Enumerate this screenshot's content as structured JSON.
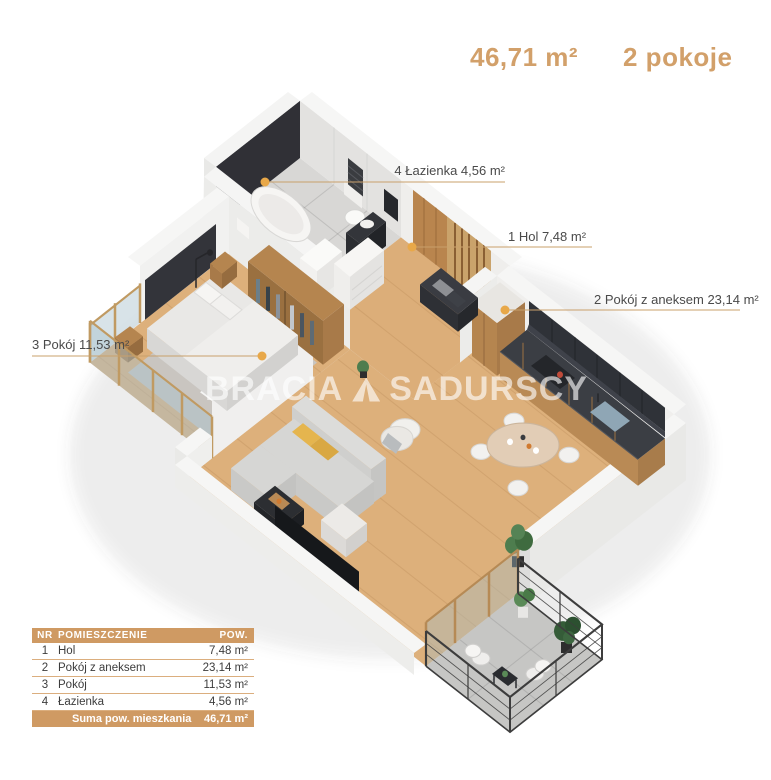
{
  "header": {
    "area": "46,71 m²",
    "rooms": "2 pokoje"
  },
  "labels": {
    "bathroom": "4 Łazienka 4,56 m²",
    "hall": "1 Hol 7,48 m²",
    "living": "2 Pokój z aneksem 23,14 m²",
    "bedroom": "3 Pokój 11,53 m²"
  },
  "watermark": {
    "left": "BRACIA",
    "right": "SADURSCY"
  },
  "table": {
    "headers": {
      "nr": "NR",
      "name": "POMIESZCZENIE",
      "area": "POW."
    },
    "rows": [
      {
        "nr": "1",
        "name": "Hol",
        "area": "7,48 m²"
      },
      {
        "nr": "2",
        "name": "Pokój z aneksem",
        "area": "23,14 m²"
      },
      {
        "nr": "3",
        "name": "Pokój",
        "area": "11,53 m²"
      },
      {
        "nr": "4",
        "name": "Łazienka",
        "area": "4,56 m²"
      }
    ],
    "footer": {
      "label": "Suma pow. mieszkania",
      "value": "46,71 m²"
    }
  },
  "colors": {
    "accent": "#CF9A63",
    "header_text": "#D2A06A",
    "label_text": "#4A4A4A",
    "leader_line": "#C9A06B",
    "marker_dot": "#E8A849",
    "dark_accent_wall": "#303036",
    "kitchen_upper": "#2F3238",
    "wood_cabinet": "#B5854F",
    "wood_floor": "#DDB07B",
    "tile_floor": "#D8D7D5",
    "balcony_floor": "#C6C6C4"
  }
}
